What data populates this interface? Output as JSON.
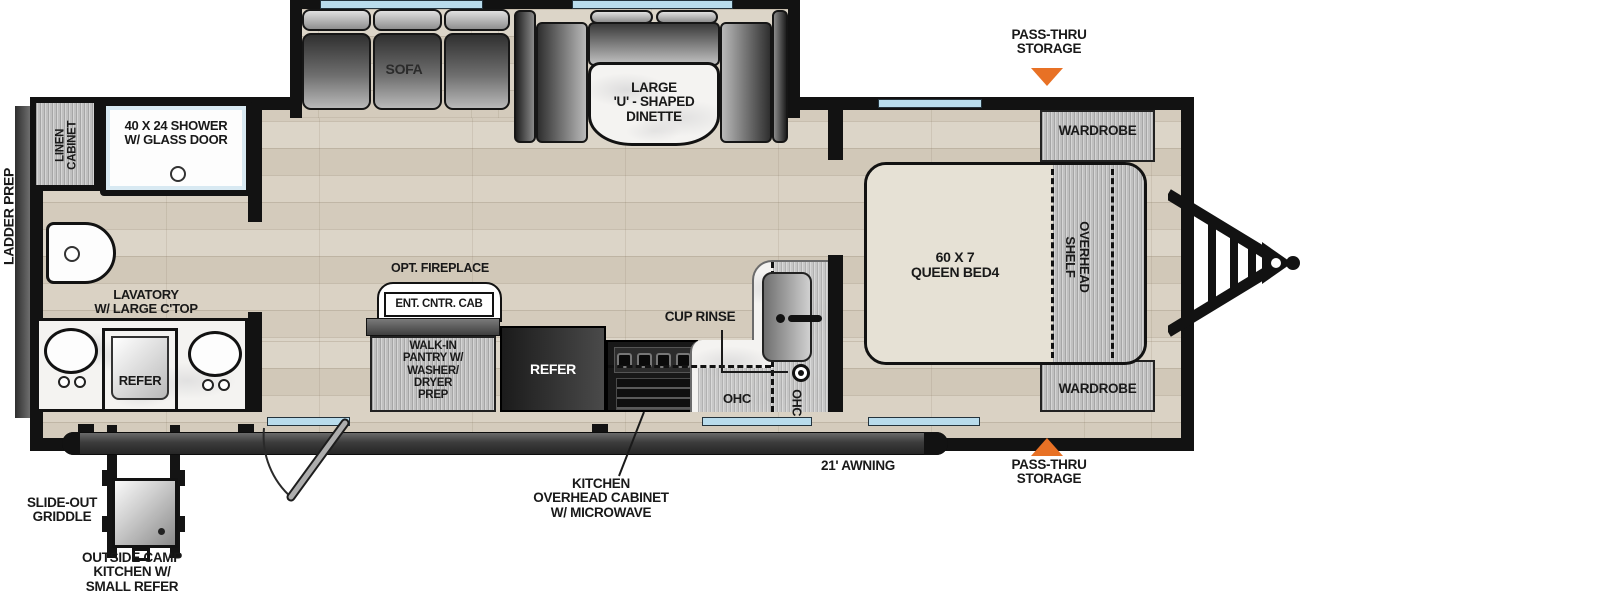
{
  "colors": {
    "accent_orange": "#e87125",
    "wall_black": "#121212",
    "window_blue": "#b9dcec",
    "floor_tan": "#d8d0c2"
  },
  "exterior": {
    "ladder_prep": "LADDER PREP",
    "pass_thru_storage_top": "PASS-THRU\nSTORAGE",
    "pass_thru_storage_bottom": "PASS-THRU\nSTORAGE",
    "awning": "21' AWNING",
    "slide_out_griddle": "SLIDE-OUT\nGRIDDLE",
    "outside_camp_kitchen": "OUTSIDE CAMP\nKITCHEN W/\nSMALL REFER"
  },
  "bathroom": {
    "linen_cabinet": "LINEN\nCABINET",
    "shower": "40 X 24 SHOWER\nW/ GLASS DOOR",
    "lavatory": "LAVATORY\nW/ LARGE C'TOP",
    "refer": "REFER"
  },
  "living": {
    "sofa": "SOFA",
    "dinette": "LARGE\n'U' - SHAPED\nDINETTE",
    "opt_fireplace": "OPT. FIREPLACE",
    "ent_cntr_cab": "ENT. CNTR. CAB",
    "pantry": "WALK-IN\nPANTRY W/\nWASHER/\nDRYER\nPREP"
  },
  "kitchen": {
    "refer": "REFER",
    "cup_rinse": "CUP RINSE",
    "ohc": "OHC",
    "ohc_vertical": "OHC",
    "overhead_cabinet": "KITCHEN\nOVERHEAD CABINET\nW/ MICROWAVE"
  },
  "bedroom": {
    "bed": "60 X 7\nQUEEN BED4",
    "wardrobe_rear": "WARDROBE",
    "wardrobe_front": "WARDROBE",
    "overhead_shelf": "OVERHEAD\nSHELF"
  }
}
